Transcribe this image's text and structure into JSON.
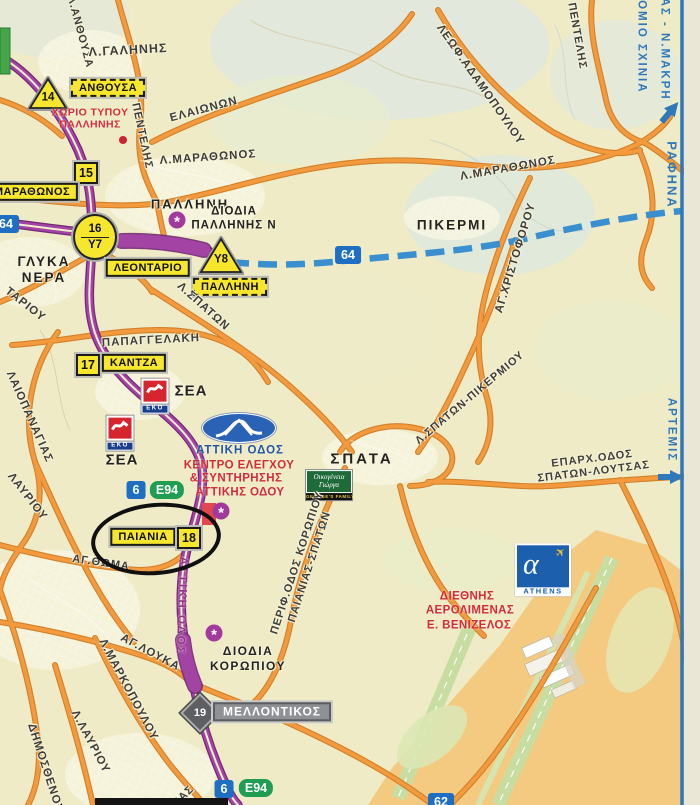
{
  "corner": {
    "line1": "ΝΑΣ - Ν.ΜΑΚΡΗ",
    "line2": "ΡΟΜΙΟ ΣΧΙΝΙΑ"
  },
  "directions": {
    "rafina": "ΡΑΦΗΝΑ",
    "artemis": "ΑΡΤΕΜΙΣ"
  },
  "shields": {
    "n64": "64",
    "n6": "6",
    "e94": "E94",
    "n62": "62"
  },
  "junctions": {
    "n14": "14",
    "n15": "15",
    "n16": "16",
    "y7": "Y7",
    "n17": "17",
    "n18": "18",
    "n19": "19",
    "y8": "Y8"
  },
  "signs": {
    "anthousa": "ΑΝΘΟΥΣΑ",
    "marathonos": "ΜΑΡΑΘΩΝΟΣ",
    "leontario": "ΛΕΟΝΤΑΡΙΟ",
    "pallini": "ΠΑΛΛΗΝΗ",
    "kantza": "ΚΑΝΤΖΑ",
    "paiania": "ΠΑΙΑΝΙΑ",
    "mellontikos": "ΜΕΛΛΟΝΤΙΚΟΣ"
  },
  "places": {
    "pallini": "ΠΑΛΛΗΝΗ",
    "pikermi": "ΠΙΚΕΡΜΙ",
    "glyka1": "ΓΛΥΚΑ",
    "glyka2": "ΝΕΡΑ",
    "spata": "ΣΠΑΤΑ",
    "papaggelaki": "ΠΑΠΑΓΓΕΛΑΚΗ",
    "sea": "ΣΕΑ",
    "xorio1": "ΧΩΡΙΟ ΤΥΠΟΥ",
    "xorio2": "ΠΑΛΛΗΝΗΣ",
    "diodia_pal1": "ΔΙΟΔΙΑ",
    "diodia_pal2": "ΠΑΛΛΗΝΗΣ Ν",
    "diodia_kor1": "ΔΙΟΔΙΑ",
    "diodia_kor2": "ΚΟΡΩΠΙΟΥ",
    "ag_thoma": "ΑΓ.ΘΩΜΑ",
    "ag_louka": "ΑΓ.ΛΟΥΚΑ"
  },
  "roads": {
    "galinis": "Λ.ΓΑΛΗΝΗΣ",
    "anthousa_rd": "Λ.ΑΝΘΟΥΣΑ",
    "pentelis": "ΠΕΝΤΕΛΗΣ",
    "elaionon": "ΕΛΑΙΩΝΩΝ",
    "adamopoulou": "ΛΕΩΦ.ΑΔΑΜΟΠΟΥΛΟΥ",
    "marathonos": "Λ.ΜΑΡΑΘΩΝΟΣ",
    "spaton": "Λ.ΣΠΑΤΩΝ",
    "tariou": "ΤΑΡΙΟΥ",
    "palaiopanagias": "ΛΑΙΟΠΑΝΑΓΙΑΣ",
    "lavriou": "ΛΑΥΡΙΟΥ",
    "xristoforou": "ΑΓ.ΧΡΙΣΤΟΦΟΡΟΥ",
    "spaton_pikermiou": "Λ.ΣΠΑΤΩΝ-ΠΙΚΕΡΜΙΟΥ",
    "eparx1": "ΕΠΑΡΧ.ΟΔΟΣ",
    "eparx2": "ΣΠΑΤΩΝ-ΛΟΥΤΣΑΣ",
    "perif1": "ΠΕΡΙΦ.ΟΔΟΣ ΚΟΡΩΠΙΟΥ",
    "perif2": "ΠΑΙΑΝΙΑΣ-ΣΠΑΤΩΝ",
    "markopoulou": "Λ.ΜΑΡΚΟΠΟΥΛΟΥ",
    "l_lavriou": "Λ.ΛΑΥΡΙΟΥ",
    "dimosthenous": "ΔΗΜΟΣΘΕΝΟΥΣ",
    "frag": "ΙΑΣ"
  },
  "attiki": {
    "logo": "ΑΤΤΙΚΗ ΟΔΟΣ",
    "kentro1": "ΚΕΝΤΡΟ ΕΛΕΓΧΟΥ",
    "kentro2": "& ΣΥΝΤΗΡΗΣΗΣ",
    "kentro3": "ΑΤΤΙΚΗΣ ΟΔΟΥ",
    "vertical": "ΑΤΤΙΚΗ ΟΔΟΣ"
  },
  "airport": {
    "l1": "ΔΙΕΘΝΗΣ",
    "l2": "ΑΕΡΟΛΙΜΕΝΑΣ",
    "l3": "Ε. ΒΕΝΙΖΕΛΟΣ",
    "logo": "ATHENS"
  },
  "pois": {
    "eko": "EKO",
    "georges1": "Οικογένεια",
    "georges2": "Γιώργα",
    "georges3": "GEORGE'S FAMILY"
  },
  "colors": {
    "motorway": "#a344a5",
    "road": "#f29a3d",
    "planned": "#3a8fd0",
    "sign_yellow": "#f6e72e",
    "info_blue": "#2e79bc",
    "poi_red": "#d32b3a"
  }
}
